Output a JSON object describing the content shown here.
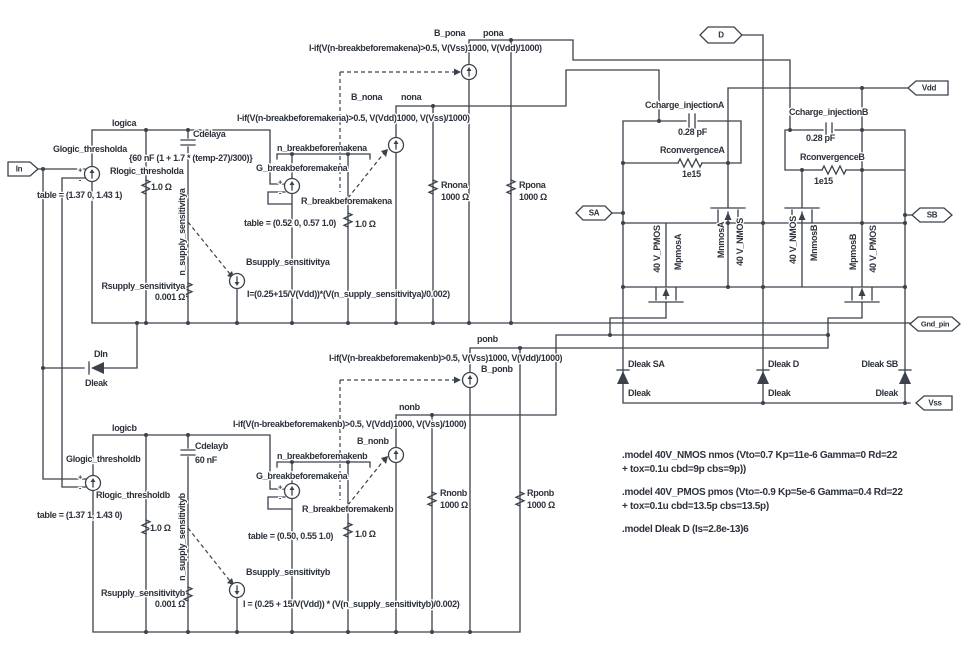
{
  "ports": {
    "in": "In",
    "d": "D",
    "vdd": "Vdd",
    "sa": "SA",
    "sb": "SB",
    "gnd": "Gnd_pin",
    "vss": "Vss"
  },
  "a": {
    "net": "logica",
    "glogic": "Glogic_thresholda",
    "glogic_table": "table = (1.37 0, 1.43 1)",
    "rlogic": "Rlogic_thresholda",
    "rlogic_val": "1.0 Ω",
    "cdelay": "Cdelaya",
    "cdelay_val": "{60 nF (1 + 1.7 * (temp-27)/300)}",
    "nsupply": "n_supply_sensitivitya",
    "rsupply": "Rsupply_sensitivitya",
    "rsupply_val": "0.001 Ω",
    "bsupply": "Bsupply_sensitivitya",
    "bsupply_formula": "I=(0.25+15/V(Vdd))*(V(n_supply_sensitivitya)/0.002)",
    "nbreak": "n_breakbeforemakena",
    "gbreak": "G_breakbeforemakena",
    "gbreak_table": "table = (0.52 0, 0.57 1.0)",
    "rbreak": "R_breakbeforemakena",
    "rbreak_val": "1.0 Ω",
    "bnon": "B_nona",
    "non_net": "nona",
    "non_formula": "I-if(V(n-breakbeforemakena)>0.5, V(Vdd)1000, V(Vss)/1000)",
    "bpon": "B_pona",
    "pon_net": "pona",
    "pon_formula": "I-if(V(n-breakbeforemakena)>0.5, V(Vss)1000, V(Vdd)/1000)",
    "rnon": "Rnona",
    "rnon_val": "1000 Ω",
    "rpon": "Rpona",
    "rpon_val": "1000 Ω"
  },
  "b": {
    "net": "logicb",
    "glogic": "Glogic_thresholdb",
    "glogic_table": "table = (1.37 1, 1.43 0)",
    "rlogic": "Rlogic_thresholdb",
    "rlogic_val": "1.0 Ω",
    "cdelay": "Cdelayb",
    "cdelay_val": "60 nF",
    "nsupply": "n_supply_sensitivityb",
    "rsupply": "Rsupply_sensitivityb",
    "rsupply_val": "0.001 Ω",
    "bsupply": "Bsupply_sensitivityb",
    "bsupply_formula": "I = (0.25 + 15/V(Vdd)) * (V(n_supply_sensitivityb)/0.002)",
    "nbreak": "n_breakbeforemakenb",
    "gbreak": "G_breakbeforemakena",
    "gbreak_table": "table = (0.50, 0.55 1.0)",
    "rbreak": "R_breakbeforemakenb",
    "rbreak_val": "1.0 Ω",
    "bnon": "B_nonb",
    "non_net": "nonb",
    "non_formula": "I-if(V(n-breakbeforemakenb)>0.5, V(Vdd)1000, V(Vss)/1000)",
    "bpon": "B_ponb",
    "pon_net": "ponb",
    "pon_formula": "I-if(V(n-breakbeforemakenb)>0.5, V(Vss)1000, V(Vdd)/1000)",
    "rnon": "Rnonb",
    "rnon_val": "1000 Ω",
    "rpon": "Rponb",
    "rpon_val": "1000 Ω"
  },
  "din": {
    "name": "DIn",
    "model": "Dleak"
  },
  "sw_a": {
    "ccharge": "Ccharge_injectionA",
    "ccharge_val": "0.28 pF",
    "rconv": "RconvergenceA",
    "rconv_val": "1e15",
    "pmos_model": "40 V_PMOS",
    "pmos": "MpmosA",
    "nmos": "MnmosA",
    "nmos_model": "40 V_NMOS"
  },
  "sw_b": {
    "ccharge": "Ccharge_injectionB",
    "ccharge_val": "0.28 pF",
    "rconv": "RconvergenceB",
    "rconv_val": "1e15",
    "nmos_model": "40 V_NMOS",
    "nmos": "MnmosB",
    "pmos": "MpmosB",
    "pmos_model": "40 V_PMOS"
  },
  "dleak": {
    "sa": "Dleak SA",
    "d": "Dleak D",
    "sb": "Dleak SB",
    "model": "Dleak"
  },
  "models": {
    "nmos_1": ".model 40V_NMOS nmos (Vto=0.7 Kp=11e-6 Gamma=0 Rd=22",
    "nmos_2": "+ tox=0.1u cbd=9p cbs=9p))",
    "pmos_1": ".model 40V_PMOS pmos (Vto=-0.9 Kp=5e-6 Gamma=0.4 Rd=22",
    "pmos_2": "+ tox=0.1u cbd=13.5p cbs=13.5p)",
    "dleak": ".model Dleak D (Is=2.8e-13)6"
  },
  "sym": {
    "plus": "+",
    "minus": "-"
  },
  "colors": {
    "wire": "#3c424b",
    "text": "#2d323b",
    "background": "#ffffff"
  }
}
